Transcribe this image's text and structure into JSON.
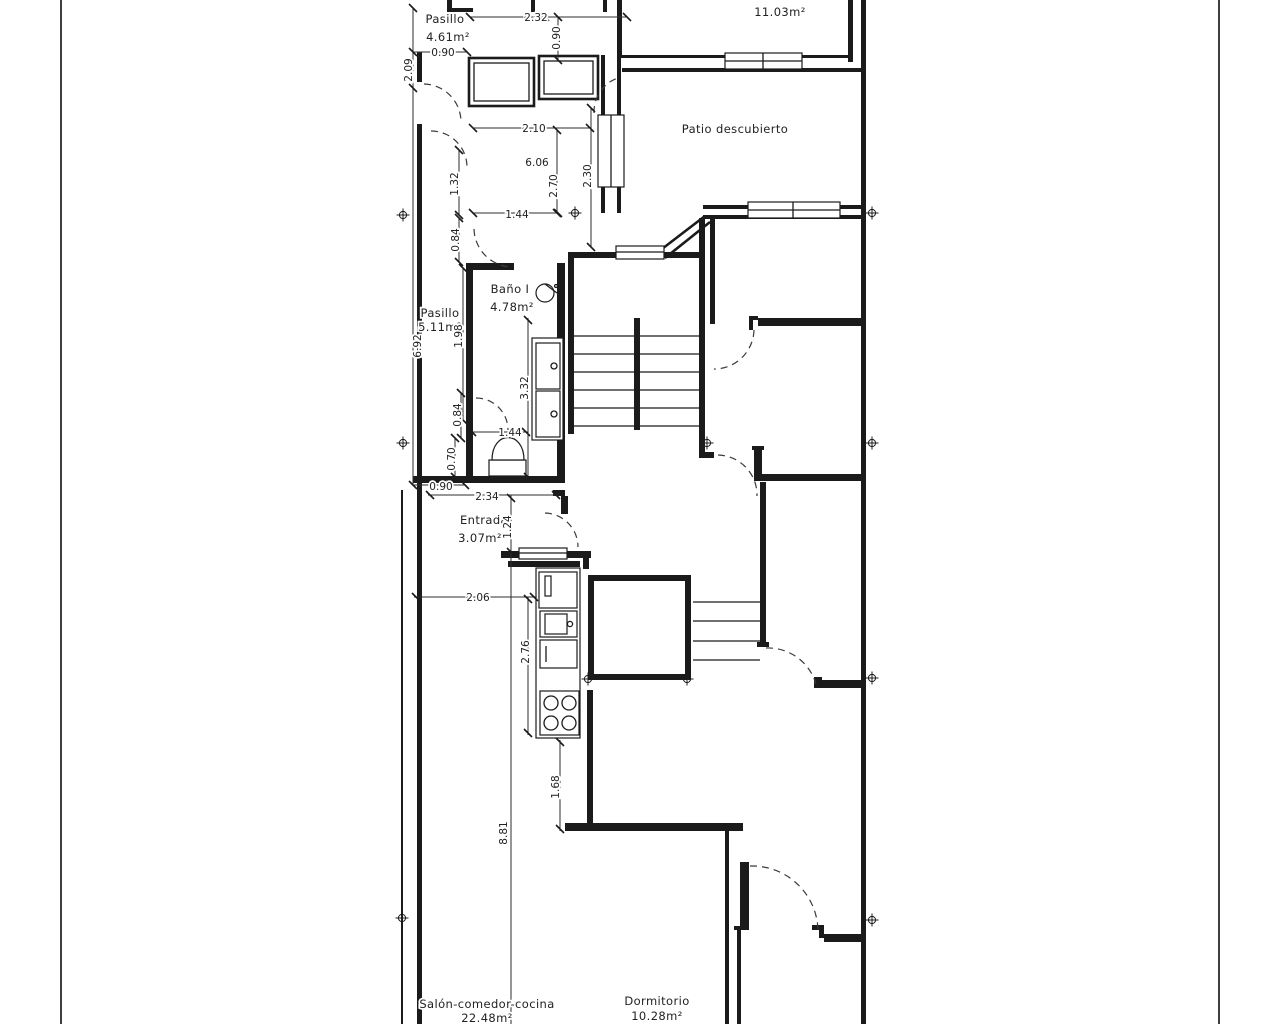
{
  "drawing_title": "Floor plan",
  "rooms": {
    "pasillo_sup": {
      "label": "Pasillo",
      "area": "4.61m²"
    },
    "lavadero": {
      "label": "",
      "area": "11.03m²"
    },
    "patio": {
      "label": "Patio descubierto",
      "area": ""
    },
    "bano1": {
      "label": "Baño I",
      "area": "4.78m²"
    },
    "pasillo_mid": {
      "label": "Pasillo",
      "area": "5.11m²"
    },
    "entrada": {
      "label": "Entrada",
      "area": "3.07m²"
    },
    "salon": {
      "label": "Salón-comedor-cocina",
      "area": "22.48m²"
    },
    "dormitorio": {
      "label": "Dormitorio",
      "area": "10.28m²"
    }
  },
  "dims": {
    "d232": "2.32",
    "d090top": "0.90",
    "d090left": "0.90",
    "d209": "2.09",
    "d210": "2.10",
    "d606": "6.06",
    "d270": "2.70",
    "d230": "2.30",
    "d132": "1.32",
    "d144a": "1.44",
    "d084a": "0.84",
    "d692": "6.92",
    "d198": "1.98",
    "d332": "3.32",
    "d084b": "0.84",
    "d144b": "1.44",
    "d070": "0.70",
    "d090b": "0.90",
    "d234": "2.34",
    "d124": "1.24",
    "d206": "2.06",
    "d276": "2.76",
    "d168": "1.68",
    "d881": "8.81"
  },
  "colors": {
    "ink": "#1b1b1b",
    "frame": "#3e3e3e",
    "paper": "#ffffff"
  }
}
